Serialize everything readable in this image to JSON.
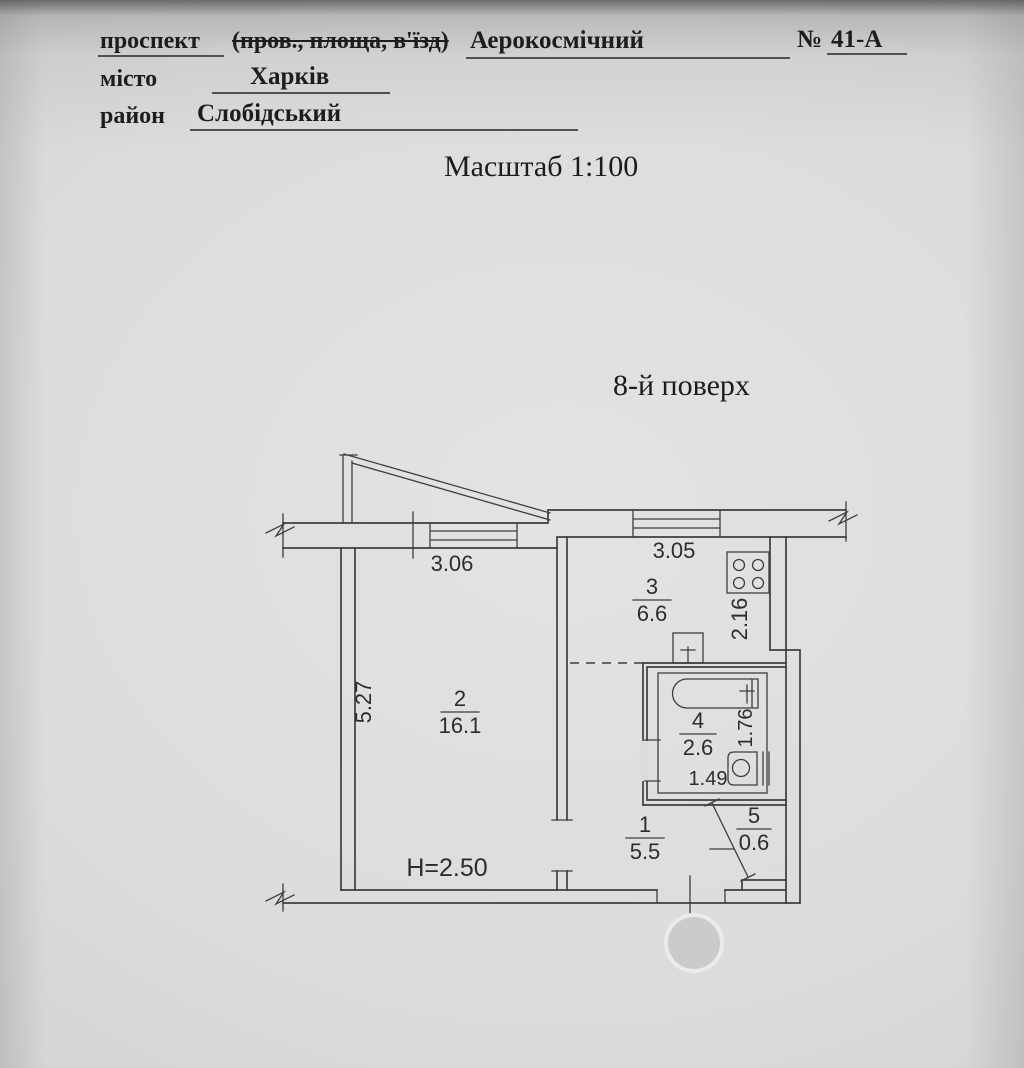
{
  "document": {
    "address_line": {
      "label": "проспект",
      "alternatives": "(пров., площа, в'їзд)",
      "value": "Аерокосмічний",
      "number_sign": "№",
      "number": "41-А"
    },
    "city_line": {
      "label": "місто",
      "value": "Харків"
    },
    "district_line": {
      "label": "район",
      "value": "Слобідський"
    },
    "scale_title": "Масштаб 1:100",
    "floor_title": "8-й поверх"
  },
  "plan": {
    "rooms": [
      {
        "number": "1",
        "area": "5.5"
      },
      {
        "number": "2",
        "area": "16.1"
      },
      {
        "number": "3",
        "area": "6.6"
      },
      {
        "number": "4",
        "area": "2.6"
      },
      {
        "number": "5",
        "area": "0.6"
      }
    ],
    "ceiling_height": "H=2.50",
    "dimensions": {
      "room2_width": "3.06",
      "room2_depth": "5.27",
      "kitchen_width": "3.05",
      "kitchen_depth": "2.16",
      "bath_width": "1.49",
      "bath_depth": "1.76"
    },
    "colors": {
      "line": "#3e3e3e",
      "paper": "#dcdcdc",
      "stamp_fill": "#cbcbcb",
      "stamp_halo": "#ebebeb"
    },
    "labels": [
      {
        "id": "room-2",
        "num": "2",
        "den": "16.1",
        "x": 460,
        "bar_y": 712,
        "bar_w": 38,
        "size": 22
      },
      {
        "id": "room-3",
        "num": "3",
        "den": "6.6",
        "x": 652,
        "bar_y": 600,
        "bar_w": 38,
        "size": 22
      },
      {
        "id": "room-4",
        "num": "4",
        "den": "2.6",
        "x": 698,
        "bar_y": 734,
        "bar_w": 36,
        "size": 22
      },
      {
        "id": "room-1",
        "num": "1",
        "den": "5.5",
        "x": 645,
        "bar_y": 838,
        "bar_w": 38,
        "size": 22
      },
      {
        "id": "room-5",
        "num": "5",
        "den": "0.6",
        "x": 754,
        "bar_y": 829,
        "bar_w": 34,
        "size": 22
      },
      {
        "id": "dim-3-06",
        "text": "3.06",
        "x": 452,
        "y": 571,
        "size": 22
      },
      {
        "id": "dim-3-05",
        "text": "3.05",
        "x": 674,
        "y": 558,
        "size": 22
      },
      {
        "id": "dim-5-27",
        "text": "5.27",
        "x": 371,
        "y": 702,
        "rot": -90,
        "size": 22
      },
      {
        "id": "dim-2-16",
        "text": "2.16",
        "x": 747,
        "y": 619,
        "rot": -90,
        "size": 22
      },
      {
        "id": "dim-1-76",
        "text": "1.76",
        "x": 752,
        "y": 728,
        "rot": -90,
        "size": 20
      },
      {
        "id": "dim-1-49",
        "text": "1.49",
        "x": 708,
        "y": 785,
        "size": 20
      },
      {
        "id": "ceiling-height",
        "text": "H=2.50",
        "x": 447,
        "y": 876,
        "size": 25
      }
    ]
  }
}
